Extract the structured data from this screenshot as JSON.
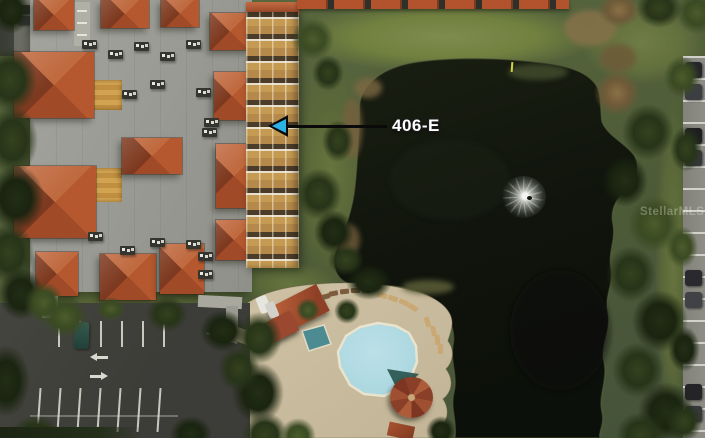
{
  "annotation": {
    "label": "406-E"
  },
  "watermark": {
    "text": "StellarMLS"
  },
  "scene": {
    "description": "Aerial satellite photo of a condominium building with red tile roofs, a dark pond with a fountain, a swimming pool with gazebo and deck, and parking lots"
  },
  "colors": {
    "arrow_cyan": "#2bb3e8",
    "annotation_line": "#0a0a0a",
    "annotation_text": "#ffffff",
    "water_dark": "#10140c",
    "pool_water": "#a5d4dd",
    "spa_water": "#4d8b92",
    "roof_red": "#b2532e",
    "roof_gray": "#9c9c96",
    "facade_tan": "#c59a52",
    "deck_tan": "#c2b496",
    "asphalt": "#3c3c38",
    "vegetation_green": "#57643c",
    "marking_white": "#d9d9d0"
  }
}
